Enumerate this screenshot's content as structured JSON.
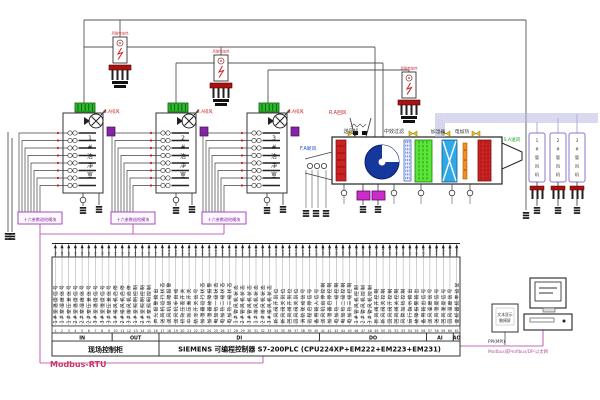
{
  "top": {
    "heater_label": "风管电加热",
    "exhaust_fan_label": "E.A排风",
    "module_label": "十六参数巡检模块",
    "rooms": [
      "1#洁净室",
      "2#洁净室",
      "3#洁净室"
    ],
    "duct_fans": [
      "1#管风机",
      "2#管风机",
      "3#管风机"
    ],
    "ahu": {
      "fresh_air": "F.A新风",
      "return_air": "R.A回风",
      "supply_fan": "送风机",
      "filter": "中效过滤",
      "humidifier": "加湿器",
      "heater": "电加热",
      "supply_air": "S.A送风"
    }
  },
  "strip": {
    "sections": [
      {
        "code": "IN",
        "count": 9
      },
      {
        "code": "OUT",
        "count": 7
      },
      {
        "code": "DI",
        "count": 24
      },
      {
        "code": "DO",
        "count": 16
      },
      {
        "code": "AI",
        "count": 4
      },
      {
        "code": "AO",
        "count": 1
      }
    ],
    "first_terminal": 1,
    "wires": [
      {
        "tag": "X1",
        "label": "1#室温度信号"
      },
      {
        "tag": "X2",
        "label": "1#室湿度信号"
      },
      {
        "tag": "X3",
        "label": "1#室压差信号"
      },
      {
        "tag": "X4",
        "label": "2#室温度信号"
      },
      {
        "tag": "X5",
        "label": "2#室湿度信号"
      },
      {
        "tag": "X6",
        "label": "2#室压差信号"
      },
      {
        "tag": "X7",
        "label": "3#室温度信号"
      },
      {
        "tag": "X8",
        "label": "3#室湿度信号"
      },
      {
        "tag": "X9",
        "label": "3#室压差信号"
      },
      {
        "tag": "Y1",
        "label": "1#排风机启停"
      },
      {
        "tag": "Y2",
        "label": "2#排风机启停"
      },
      {
        "tag": "Y3",
        "label": "3#排风机启停"
      },
      {
        "tag": "Y4",
        "label": "1#室照明控制"
      },
      {
        "tag": "Y5",
        "label": "2#室照明控制"
      },
      {
        "tag": "Y6",
        "label": "3#室照明控制"
      },
      {
        "tag": "Y7",
        "label": "声光报警输出"
      },
      {
        "tag": "I0.0",
        "label": "送风机运行状态"
      },
      {
        "tag": "I0.1",
        "label": "送风机故障报警"
      },
      {
        "tag": "I0.2",
        "label": "送风机手自动"
      },
      {
        "tag": "I0.3",
        "label": "初效压差开关"
      },
      {
        "tag": "I0.4",
        "label": "中效压差开关"
      },
      {
        "tag": "I0.5",
        "label": "防冻开关信号"
      },
      {
        "tag": "I0.6",
        "label": "加湿器运行状态"
      },
      {
        "tag": "I0.7",
        "label": "加湿器故障报警"
      },
      {
        "tag": "I1.0",
        "label": "电加热一级状态"
      },
      {
        "tag": "I1.1",
        "label": "电加热二级状态"
      },
      {
        "tag": "I1.2",
        "label": "电加热三级状态"
      },
      {
        "tag": "I1.3",
        "label": "1#管风机状态"
      },
      {
        "tag": "I1.4",
        "label": "2#管风机状态"
      },
      {
        "tag": "I1.5",
        "label": "3#管风机状态"
      },
      {
        "tag": "I1.6",
        "label": "1#排风机状态"
      },
      {
        "tag": "I1.7",
        "label": "2#排风机状态"
      },
      {
        "tag": "I2.0",
        "label": "3#排风机状态"
      },
      {
        "tag": "I2.1",
        "label": "新风阀开到位"
      },
      {
        "tag": "I2.2",
        "label": "新风阀关到位"
      },
      {
        "tag": "I2.3",
        "label": "回风阀开到位"
      },
      {
        "tag": "I2.4",
        "label": "回风阀关到位"
      },
      {
        "tag": "I2.5",
        "label": "消防联动信号"
      },
      {
        "tag": "I2.6",
        "label": "远程启停信号"
      },
      {
        "tag": "I2.7",
        "label": "备用输入信号"
      },
      {
        "tag": "Q0.0",
        "label": "送风机启停控制"
      },
      {
        "tag": "Q0.1",
        "label": "加湿器启停控制"
      },
      {
        "tag": "Q0.2",
        "label": "电加热一级控制"
      },
      {
        "tag": "Q0.3",
        "label": "电加热二级控制"
      },
      {
        "tag": "Q0.4",
        "label": "电加热三级控制"
      },
      {
        "tag": "Q0.5",
        "label": "1#管风机控制"
      },
      {
        "tag": "Q0.6",
        "label": "2#管风机控制"
      },
      {
        "tag": "Q0.7",
        "label": "3#管风机控制"
      },
      {
        "tag": "Q1.0",
        "label": "新风阀开控制"
      },
      {
        "tag": "Q1.1",
        "label": "新风阀关控制"
      },
      {
        "tag": "Q1.2",
        "label": "回风阀开控制"
      },
      {
        "tag": "Q1.3",
        "label": "回风阀关控制"
      },
      {
        "tag": "Q1.4",
        "label": "风管加热控制"
      },
      {
        "tag": "Q1.5",
        "label": "运行指示输出"
      },
      {
        "tag": "Q1.6",
        "label": "故障报警输出"
      },
      {
        "tag": "Q1.7",
        "label": "备用输出信号"
      },
      {
        "tag": "AIW0",
        "label": "送风温度信号"
      },
      {
        "tag": "AIW2",
        "label": "送风湿度信号"
      },
      {
        "tag": "AIW4",
        "label": "回风温度信号"
      },
      {
        "tag": "AIW6",
        "label": "回风湿度信号"
      },
      {
        "tag": "AQW0",
        "label": "变频器频率给定"
      }
    ]
  },
  "bottom": {
    "cabinet": "现场控制柜",
    "plc": "SIEMENS  可编程控制器 S7-200PLC (CPU224XP+EM222+EM223+EM231)",
    "modbus": "Modbus-RTU",
    "ppi": "PPI(MPI)",
    "network": "Modbus或Profibus/DP-以太网",
    "display": [
      "文本显示",
      "触摸屏"
    ]
  },
  "colors": {
    "network_pink": "#c76bb8",
    "alarm_red": "#cc2222",
    "fan_blue": "#16379c",
    "filter_green": "#5ae637",
    "humidifier_blue": "#2fa8e8",
    "terminal_green": "#2eb82e",
    "module_purple": "#a44fc0"
  }
}
